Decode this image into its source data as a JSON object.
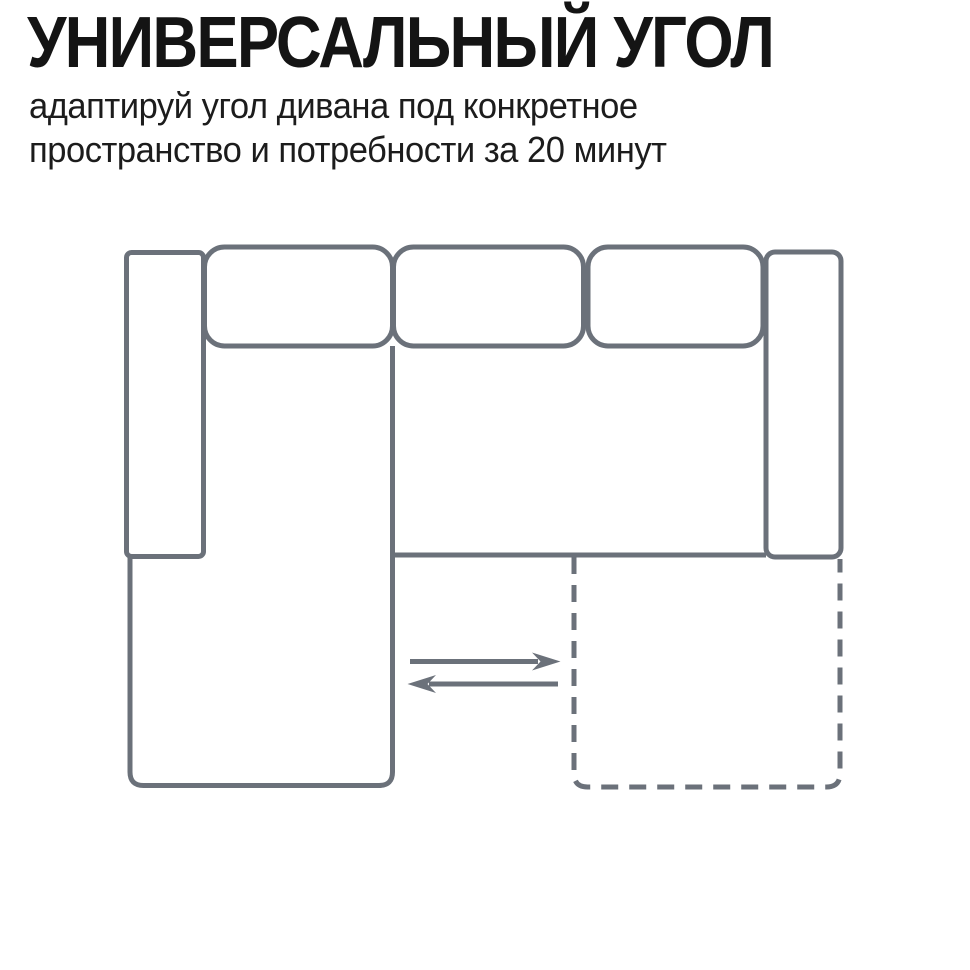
{
  "header": {
    "title": "УНИВЕРСАЛЬНЫЙ УГОЛ",
    "subtitle_line1": "адаптируй угол дивана под конкретное",
    "subtitle_line2": "пространство и потребности за 20 минут"
  },
  "colors": {
    "background": "#ffffff",
    "title_text": "#141414",
    "subtitle_text": "#1c1c1c"
  },
  "diagram": {
    "stroke_color": "#6b717a"
  }
}
